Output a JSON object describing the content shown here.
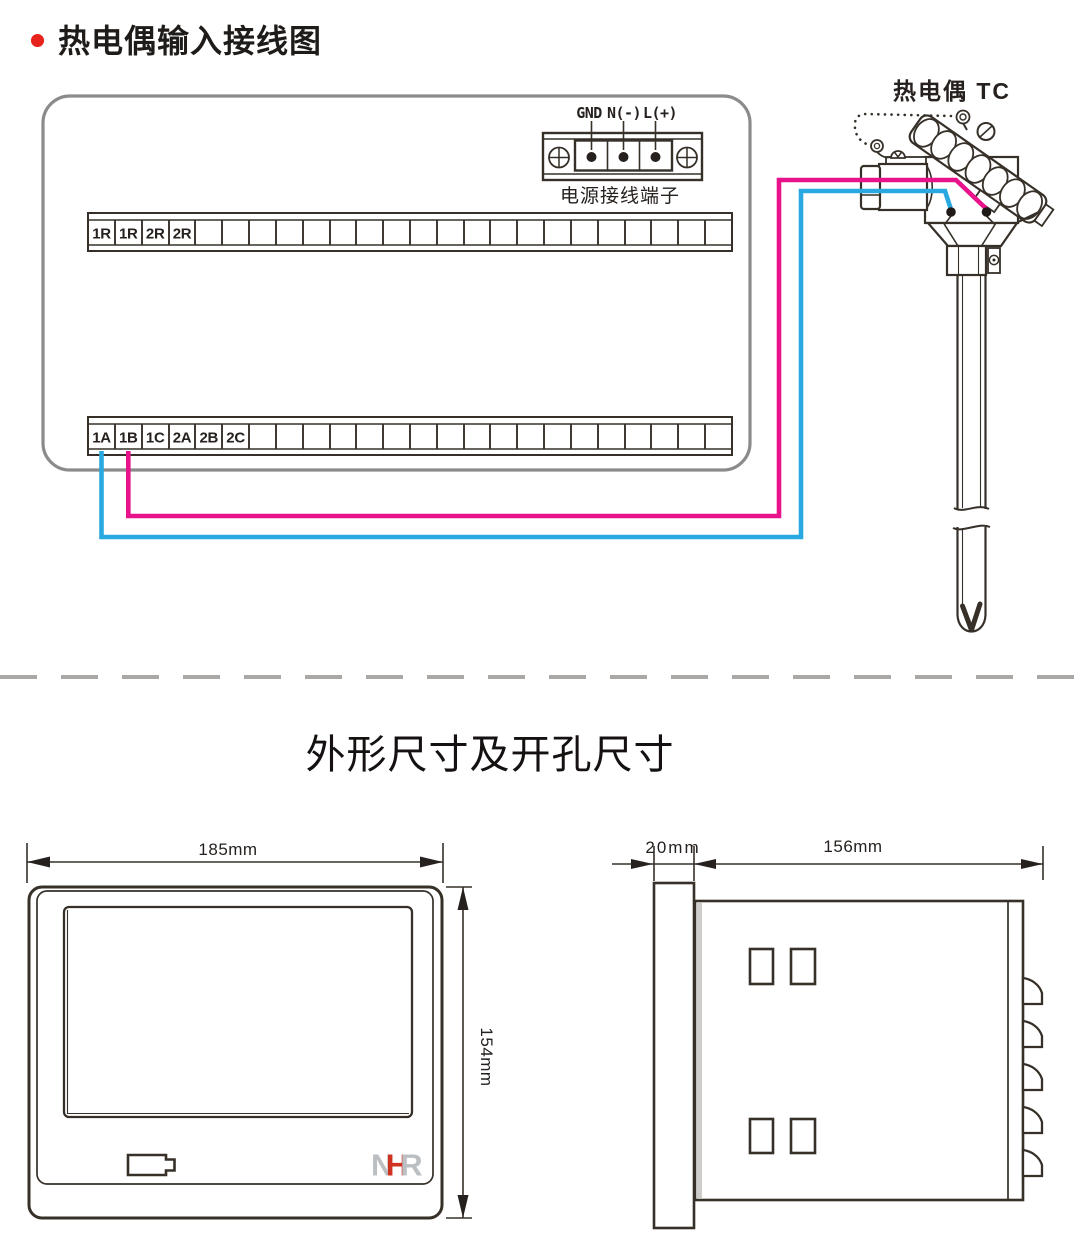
{
  "wiring_section": {
    "title": "热电偶输入接线图",
    "power_terminal": {
      "labels": {
        "gnd": "GND",
        "neutral": "N(-)",
        "line": "L(+)"
      },
      "caption": "电源接线端子"
    },
    "thermocouple_label": "热电偶 TC",
    "upper_terminal_labels": [
      "1R",
      "1R",
      "2R",
      "2R"
    ],
    "lower_terminal_labels": [
      "1A",
      "1B",
      "1C",
      "2A",
      "2B",
      "2C"
    ],
    "colors": {
      "wire_pink": "#e8138b",
      "wire_blue": "#2aa9e1",
      "bullet_red": "#e8231c",
      "device_outline_gray": "#8d8a8a",
      "divider_gray": "#aba7a5"
    }
  },
  "dimensions_section": {
    "title": "外形尺寸及开孔尺寸",
    "front_view": {
      "width": "185mm",
      "height": "154mm",
      "logo_letters": {
        "n": "N",
        "h": "H",
        "r": "R"
      },
      "logo_colors": {
        "gray": "#bcbfc2",
        "red": "#d03222"
      }
    },
    "side_view": {
      "panel_depth": "20mm",
      "body_depth": "156mm"
    }
  }
}
